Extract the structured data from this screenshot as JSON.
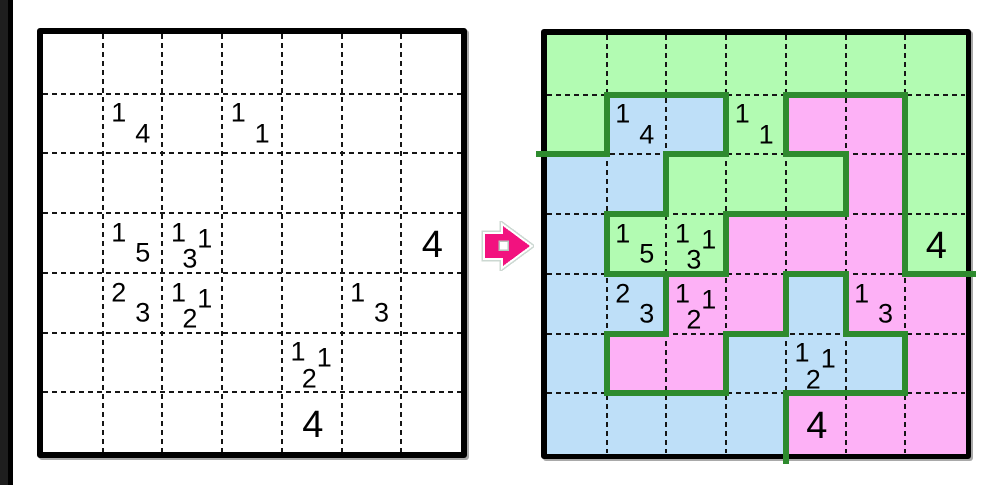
{
  "page": {
    "background": "#ffffff",
    "edge_bar_color": "#000000",
    "edge_bar_inner_color": "#1e1e1e"
  },
  "puzzle": {
    "rows": 7,
    "cols": 7,
    "frame_color": "#000000",
    "grid_line_color": "#161616",
    "clue_color": "#000000",
    "border_color": "#2e8b2e",
    "region_colors": {
      "G": "#b2fbb2",
      "B": "#bedff8",
      "P": "#fdb1f6"
    },
    "solution_regions": [
      "GGGGGGG",
      "GBBGPPG",
      "BBGGGPG",
      "BGGPPPG",
      "BBPPBPP",
      "BPPBBBP",
      "BBBBPPP"
    ],
    "clues": [
      {
        "row": 1,
        "col": 1,
        "size": "small",
        "digits": [
          {
            "v": "1",
            "pos": "tl"
          },
          {
            "v": "4",
            "pos": "br"
          }
        ]
      },
      {
        "row": 1,
        "col": 3,
        "size": "small",
        "digits": [
          {
            "v": "1",
            "pos": "tl"
          },
          {
            "v": "1",
            "pos": "br"
          }
        ]
      },
      {
        "row": 3,
        "col": 1,
        "size": "small",
        "digits": [
          {
            "v": "1",
            "pos": "tl"
          },
          {
            "v": "5",
            "pos": "br"
          }
        ]
      },
      {
        "row": 3,
        "col": 2,
        "size": "small",
        "digits": [
          {
            "v": "1",
            "pos": "tl"
          },
          {
            "v": "3",
            "pos": "b"
          },
          {
            "v": "1",
            "pos": "tr"
          }
        ]
      },
      {
        "row": 3,
        "col": 6,
        "size": "big",
        "digits": [
          {
            "v": "4",
            "pos": "c"
          }
        ]
      },
      {
        "row": 4,
        "col": 1,
        "size": "small",
        "digits": [
          {
            "v": "2",
            "pos": "tl"
          },
          {
            "v": "3",
            "pos": "br"
          }
        ]
      },
      {
        "row": 4,
        "col": 2,
        "size": "small",
        "digits": [
          {
            "v": "1",
            "pos": "tl"
          },
          {
            "v": "2",
            "pos": "b"
          },
          {
            "v": "1",
            "pos": "tr"
          }
        ]
      },
      {
        "row": 4,
        "col": 5,
        "size": "small",
        "digits": [
          {
            "v": "1",
            "pos": "tl"
          },
          {
            "v": "3",
            "pos": "br"
          }
        ]
      },
      {
        "row": 5,
        "col": 4,
        "size": "small",
        "digits": [
          {
            "v": "1",
            "pos": "tl"
          },
          {
            "v": "2",
            "pos": "b"
          },
          {
            "v": "1",
            "pos": "tr"
          }
        ]
      },
      {
        "row": 6,
        "col": 4,
        "size": "big",
        "digits": [
          {
            "v": "4",
            "pos": "c"
          }
        ]
      }
    ]
  },
  "arrow": {
    "label": "transform-arrow",
    "color": "#f2127f",
    "outline_color": "#ffffff",
    "rim_color": "#ccd8d2",
    "hole_color": "#ffffff",
    "hole_rim_color": "#b9c4bd"
  }
}
